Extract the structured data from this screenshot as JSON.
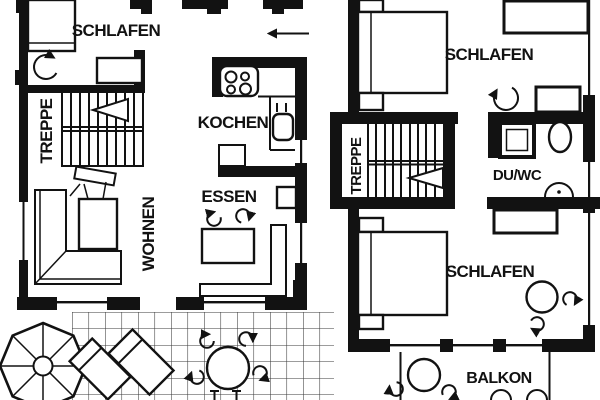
{
  "document": {
    "title": "Two-storey apartment floor plan"
  },
  "colors": {
    "ink": "#121212",
    "paper": "#ffffff",
    "paving_grid": "#3a3a3a"
  },
  "ground_floor": {
    "labels": {
      "schlafen": "SCHLAFEN",
      "treppe": "TREPPE",
      "kochen": "KOCHEN",
      "essen": "ESSEN",
      "wohnen": "WOHNEN"
    }
  },
  "upper_floor": {
    "labels": {
      "schlafen_top": "SCHLAFEN",
      "treppe": "TREPPE",
      "du_wc": "DU/WC",
      "schlafen_bottom": "SCHLAFEN",
      "balkon": "BALKON"
    }
  },
  "icons": {
    "entrance_arrow": "left-pointing entry arrow",
    "stair_direction_arrow": "triangular flight arrow",
    "door_swing_arrow": "curved door-swing arrow",
    "chair_arrow": "curved chair symbol",
    "stove": "cooktop with four burners",
    "sink": "kitchen sink with taps",
    "shower": "shower tray",
    "toilet": "WC bowl",
    "washbasin": "half-round washbasin",
    "bed": "double bed with bedside tables",
    "wardrobe": "wardrobe",
    "sofa": "L-shaped sofa",
    "dining_bench": "corner bench with table",
    "round_table": "round table",
    "parasol": "parasol umbrella",
    "sun_lounger": "sun lounger",
    "paving": "terrace paving grid"
  }
}
